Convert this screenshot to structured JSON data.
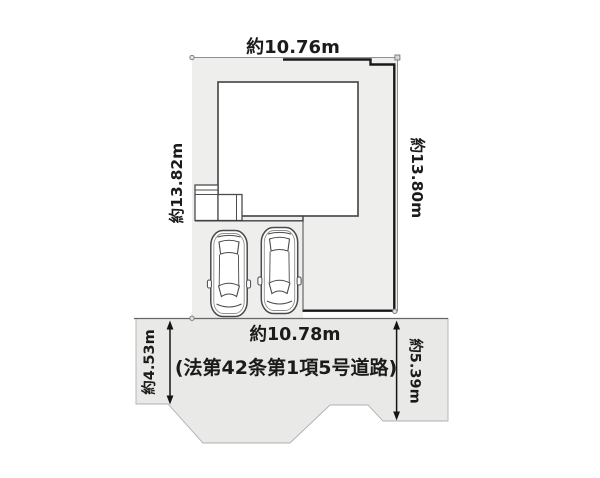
{
  "plan": {
    "title": "property-lot-site-plan",
    "dimensions": {
      "top_width": "約10.76m",
      "left_depth": "約13.82m",
      "right_depth": "約13.80m",
      "frontage": "約10.78m",
      "road_width_left": "約4.53m",
      "road_width_right": "約5.39m"
    },
    "road": {
      "name": "(法第42条第1項5号道路)"
    },
    "features": {
      "building": "house-footprint",
      "porch": "entrance-steps",
      "parking": "2-cars"
    },
    "colors": {
      "lot_fill": "#eeeeed",
      "road_fill": "#e9e9e8",
      "building_fill": "#ffffff",
      "outline": "#4c4c4c",
      "boundary_thick": "#191919",
      "thin_line": "#909090",
      "text": "#1b1b1b"
    }
  }
}
